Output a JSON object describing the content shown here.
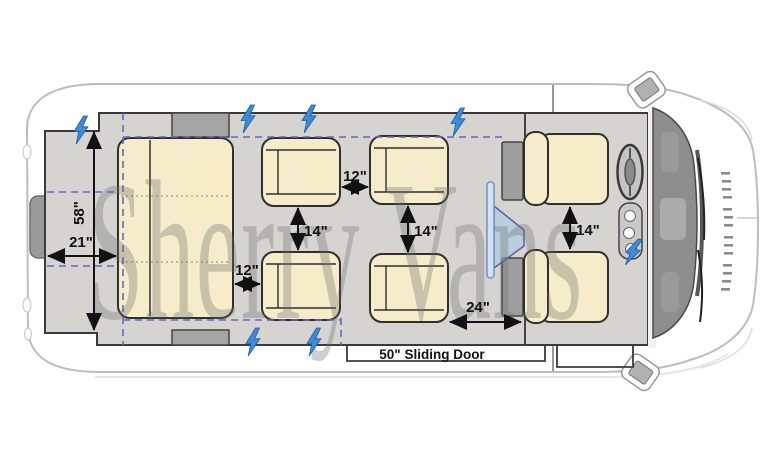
{
  "diagram": {
    "type": "van-seating-floor-plan",
    "watermark": "Sherry Vans",
    "labels": {
      "rear_opening_width": "58\"",
      "rear_cargo_depth": "21\"",
      "front_row_gap": "12\"",
      "bench_to_chair_gap": "12\"",
      "left_aisle_gap": "14\"",
      "right_aisle_gap": "14\"",
      "front_seats_gap": "14\"",
      "chair_to_cab_gap": "24\"",
      "sliding_door": "50\" Sliding Door"
    },
    "icons": {
      "power_outlet": "lightning-bolt-icon",
      "tv": "flip-down-tv-icon"
    },
    "colors": {
      "seat_fill": "#f7ecca",
      "seat_stroke": "#2f2f2f",
      "floor_fill": "#d5d4d1",
      "guide_dash": "#6666bb",
      "bolt_blue": "#3f8ad2",
      "tv_blue": "#cfe2f6",
      "well_gray": "#a5a5a5",
      "body_stroke": "#bdbdbd"
    }
  }
}
